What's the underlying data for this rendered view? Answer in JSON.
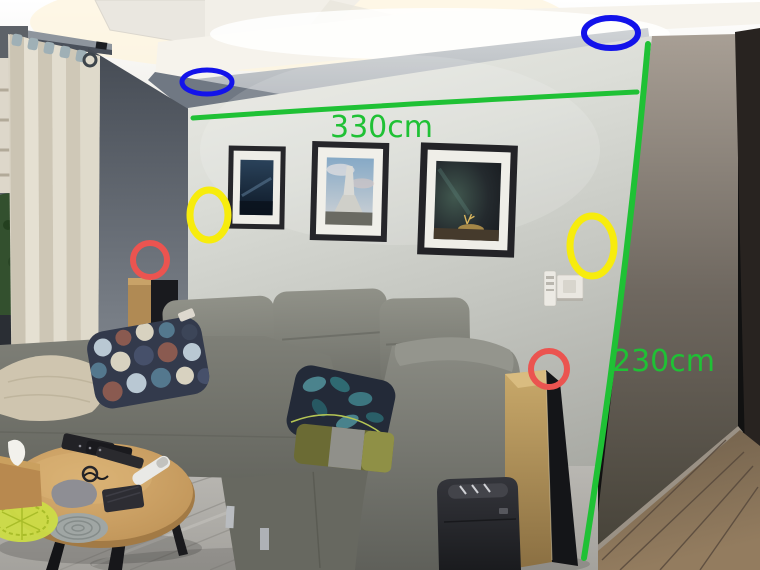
{
  "annotations": {
    "measurements": {
      "width_label": "330cm",
      "height_label": "230cm"
    },
    "colors": {
      "green": "#1fc135",
      "blue": "#1313ea",
      "yellow": "#f7ec0d",
      "red": "#eb5450"
    },
    "markers": [
      {
        "name": "blue-oval-left",
        "color": "blue"
      },
      {
        "name": "blue-oval-right",
        "color": "blue"
      },
      {
        "name": "yellow-oval-left",
        "color": "yellow"
      },
      {
        "name": "yellow-oval-right",
        "color": "yellow"
      },
      {
        "name": "red-oval-left",
        "color": "red"
      },
      {
        "name": "red-oval-right",
        "color": "red"
      }
    ]
  }
}
